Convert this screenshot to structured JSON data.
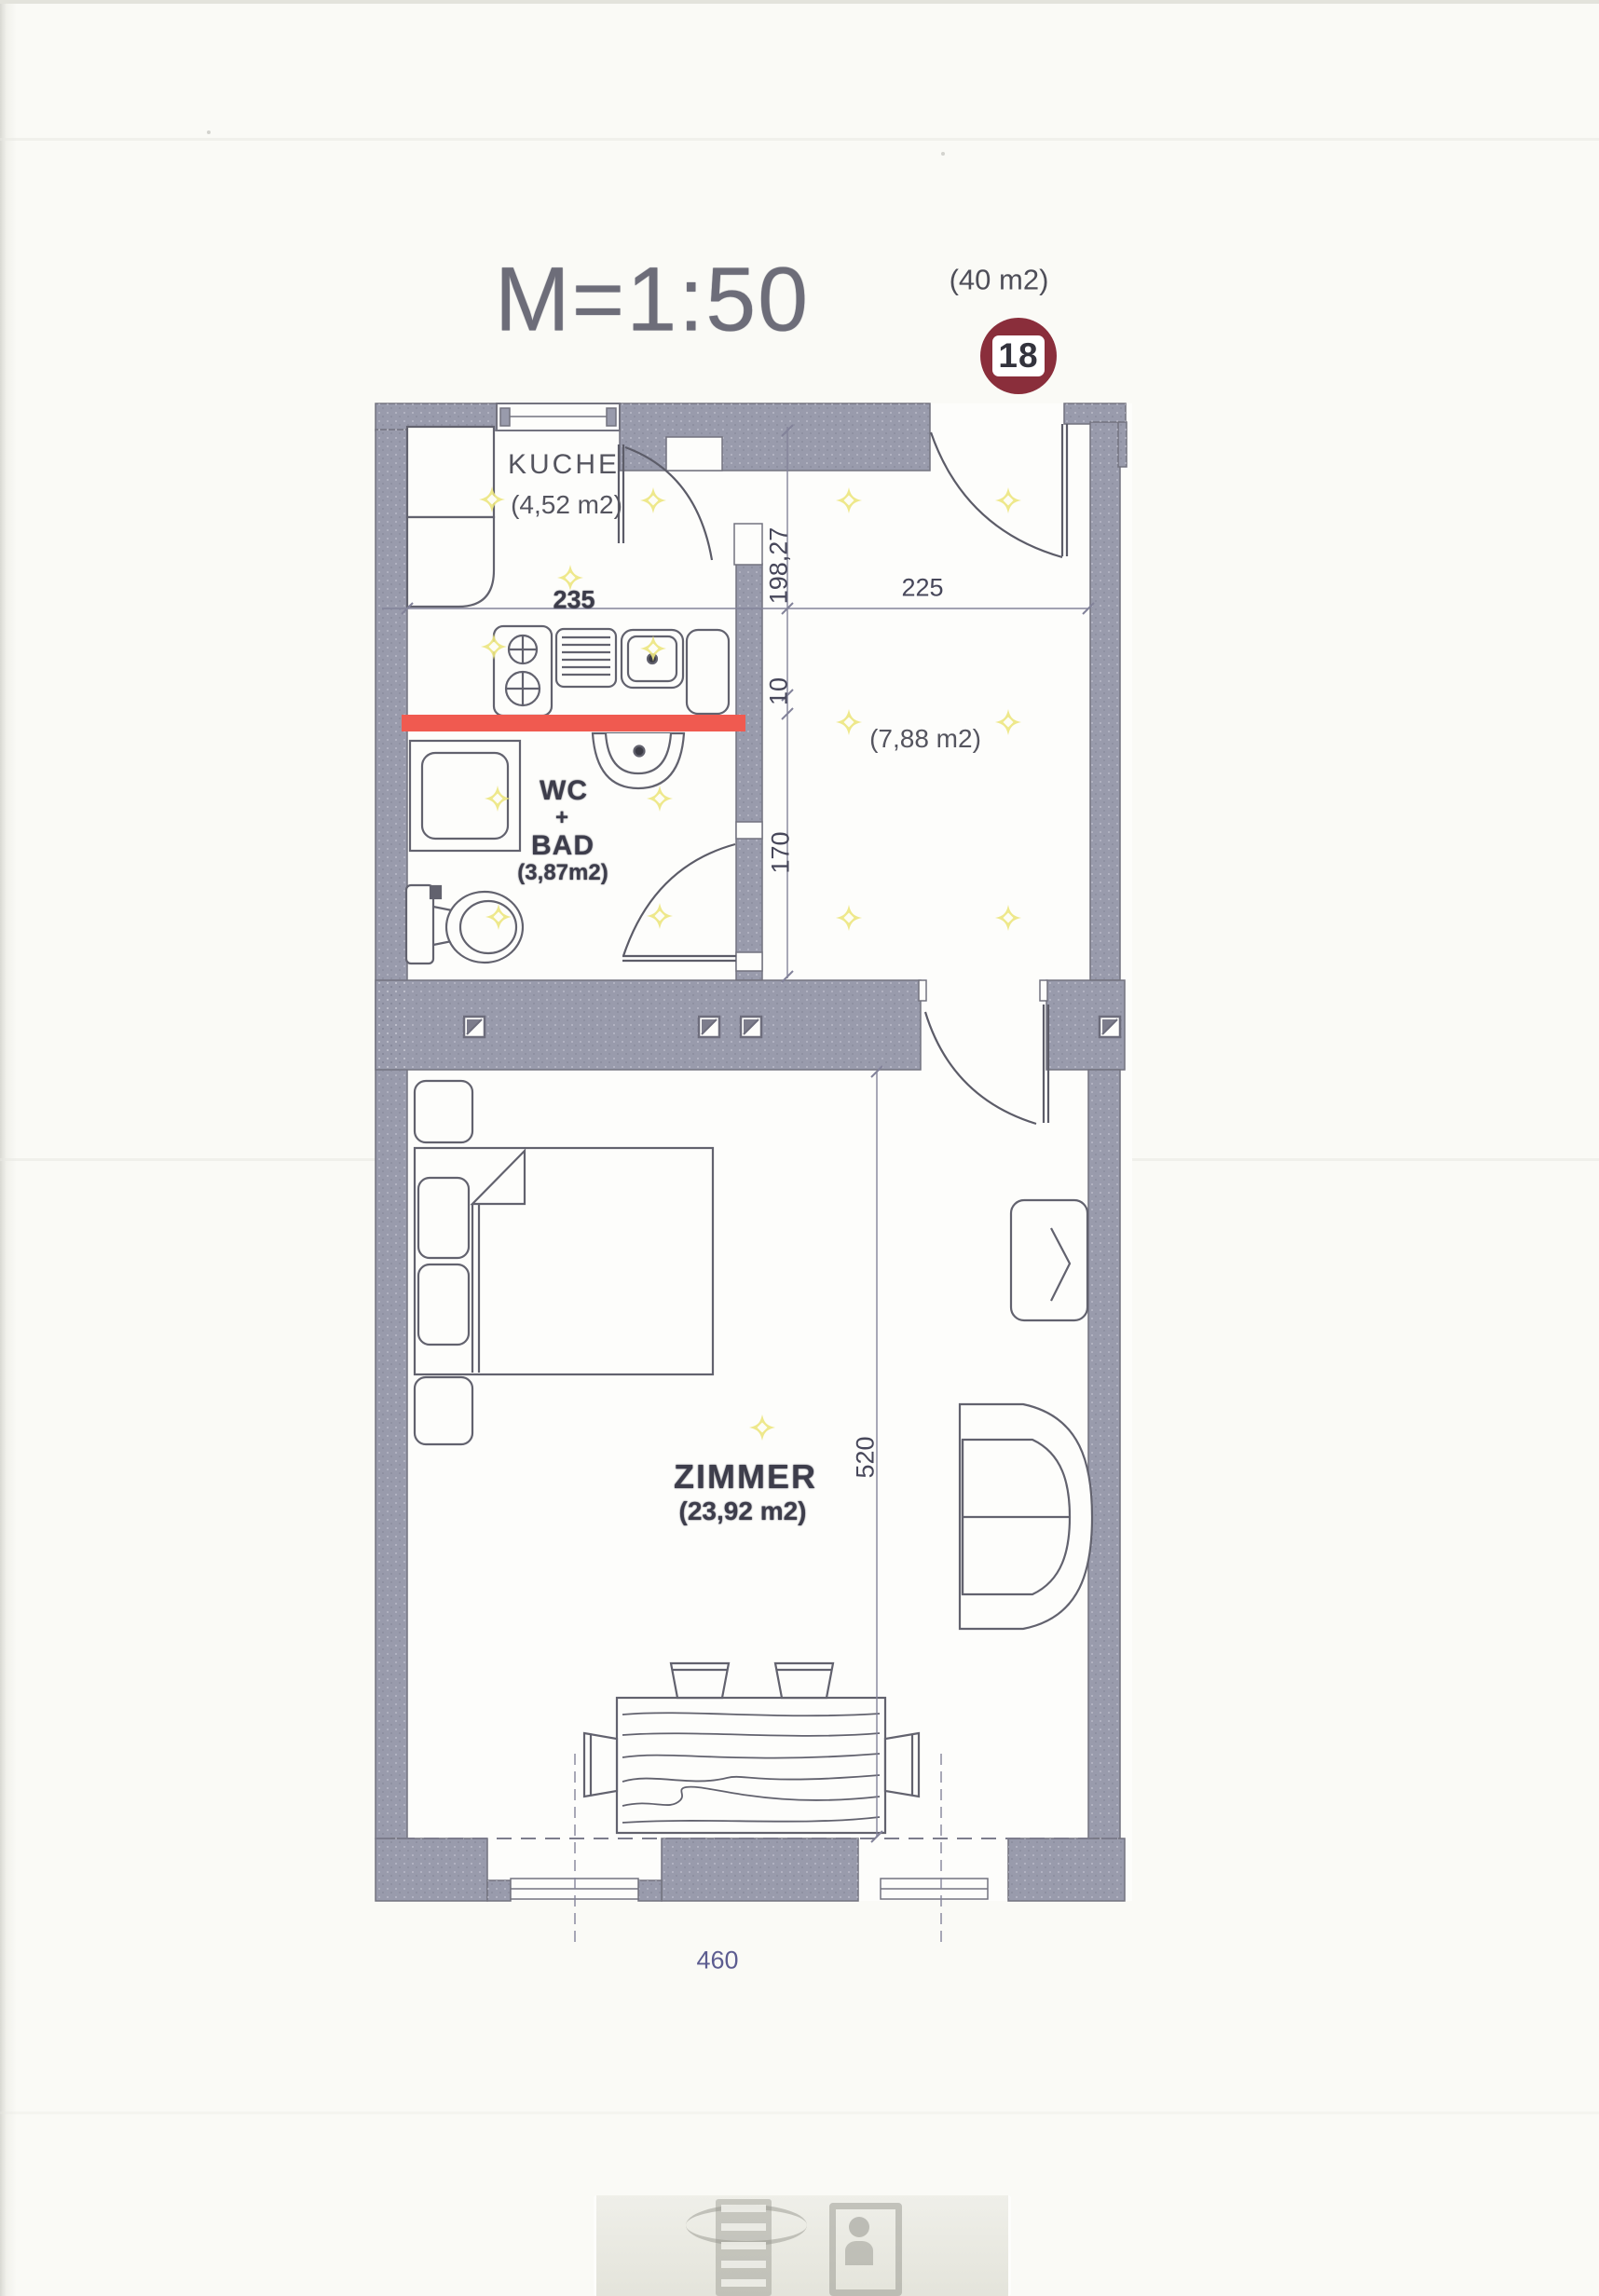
{
  "header": {
    "scale_label": "M=1:50",
    "total_area": "(40 m2)",
    "unit_number": "18"
  },
  "rooms": {
    "kueche": {
      "name": "KUCHE",
      "area": "(4,52 m2)"
    },
    "bad": {
      "line1": "WC",
      "line2": "+",
      "line3": "BAD",
      "area": "(3,87m2)"
    },
    "vorraum": {
      "area": "(7,88 m2)"
    },
    "zimmer": {
      "name": "ZIMMER",
      "area": "(23,92 m2)"
    }
  },
  "dimensions": {
    "kueche_width": "235",
    "vorraum_width": "225",
    "kueche_depth": "198,27",
    "wall_thickness": "10",
    "bad_depth": "170",
    "zimmer_depth": "520",
    "zimmer_width": "460"
  },
  "colors": {
    "wall": "#999bac",
    "wall_edge": "#73737f",
    "drawing_line": "#5f5f6c",
    "red_marker": "#f05a50",
    "badge_bg": "#8a2e3b",
    "light_yellow": "#ece67e",
    "dim_blue": "#5c5c90"
  },
  "icons": {
    "light": "light-icon",
    "vent": "vent-icon"
  },
  "lights": [
    [
      528,
      536
    ],
    [
      612,
      620
    ],
    [
      701,
      537
    ],
    [
      530,
      694
    ],
    [
      701,
      696
    ],
    [
      911,
      537
    ],
    [
      1082,
      537
    ],
    [
      911,
      775
    ],
    [
      1082,
      775
    ],
    [
      911,
      985
    ],
    [
      1082,
      985
    ],
    [
      534,
      857
    ],
    [
      708,
      857
    ],
    [
      535,
      984
    ],
    [
      708,
      983
    ],
    [
      818,
      1532
    ]
  ]
}
